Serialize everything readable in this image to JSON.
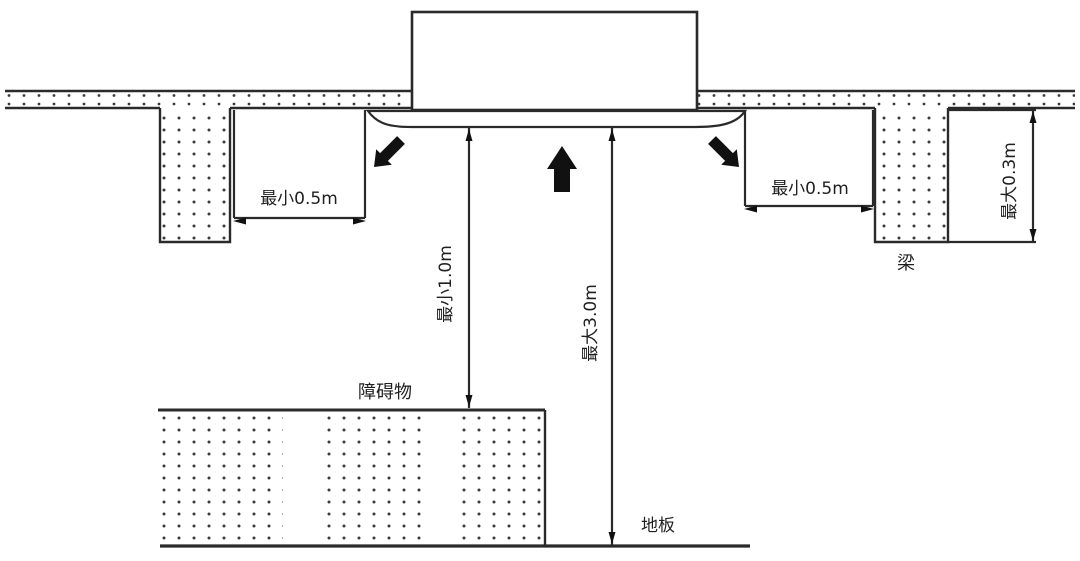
{
  "page": {
    "background": "#ffffff",
    "line_color": "#2a2a2a",
    "dot_color": "#3a3a3a"
  },
  "diagram": {
    "kind": "installation-clearance-diagram",
    "labels": {
      "clearance_left": "最小0.5m",
      "clearance_right": "最小0.5m",
      "beam_max_depth": "最大0.3m",
      "beam": "梁",
      "min_distance_to_obstacle": "最小1.0m",
      "max_distance_to_floor": "最大3.0m",
      "obstacle": "障碍物",
      "floor": "地板"
    }
  }
}
